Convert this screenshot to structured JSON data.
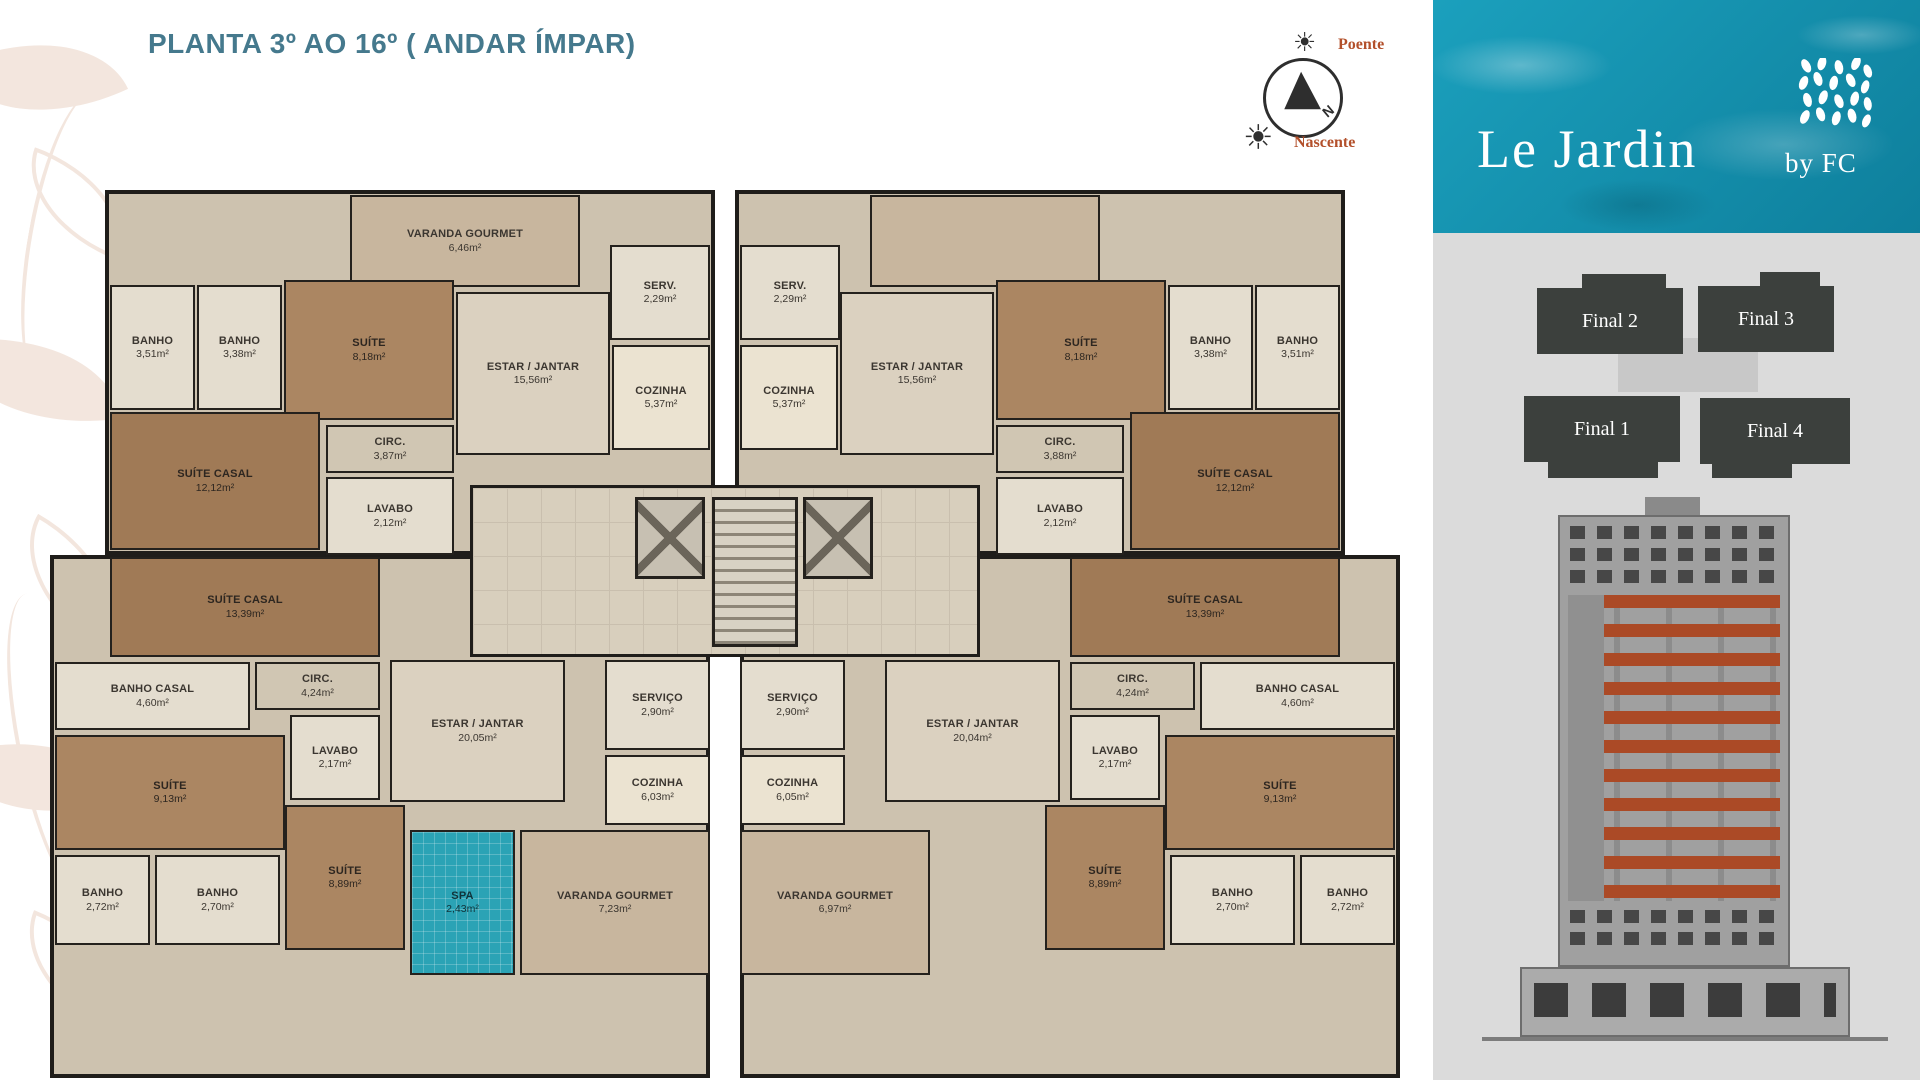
{
  "title": "PLANTA 3º AO 16º ( ANDAR ÍMPAR)",
  "compass": {
    "north": "N",
    "poente": "Poente",
    "nascente": "Nascente"
  },
  "brand": {
    "name": "Le Jardin",
    "by": "by FC"
  },
  "key_plan": {
    "final1": "Final 1",
    "final2": "Final 2",
    "final3": "Final 3",
    "final4": "Final 4"
  },
  "colors": {
    "title_teal": "#45798d",
    "accent_rust": "#b3502b",
    "sidebar_water": "#148ca8",
    "sidebar_gray": "#dbdbdb",
    "keyplan_block": "#3c403d",
    "elevation_highlight": "#ab4a26",
    "wall": "#1f1d1a"
  },
  "plan": {
    "top_left": {
      "varanda": {
        "label": "VARANDA GOURMET",
        "area": "6,46m²"
      },
      "serv": {
        "label": "SERV.",
        "area": "2,29m²"
      },
      "cozinha": {
        "label": "COZINHA",
        "area": "5,37m²"
      },
      "estar": {
        "label": "ESTAR / JANTAR",
        "area": "15,56m²"
      },
      "circ": {
        "label": "CIRC.",
        "area": "3,87m²"
      },
      "suite": {
        "label": "SUÍTE",
        "area": "8,18m²"
      },
      "banho_a": {
        "label": "BANHO",
        "area": "3,38m²"
      },
      "banho_b": {
        "label": "BANHO",
        "area": "3,51m²"
      },
      "suite_casal": {
        "label": "SUÍTE CASAL",
        "area": "12,12m²"
      },
      "lavabo": {
        "label": "LAVABO",
        "area": "2,12m²"
      }
    },
    "top_right": {
      "serv": {
        "label": "SERV.",
        "area": "2,29m²"
      },
      "cozinha": {
        "label": "COZINHA",
        "area": "5,37m²"
      },
      "estar": {
        "label": "ESTAR / JANTAR",
        "area": "15,56m²"
      },
      "circ": {
        "label": "CIRC.",
        "area": "3,88m²"
      },
      "suite": {
        "label": "SUÍTE",
        "area": "8,18m²"
      },
      "banho_a": {
        "label": "BANHO",
        "area": "3,38m²"
      },
      "banho_b": {
        "label": "BANHO",
        "area": "3,51m²"
      },
      "suite_casal": {
        "label": "SUÍTE CASAL",
        "area": "12,12m²"
      },
      "lavabo": {
        "label": "LAVABO",
        "area": "2,12m²"
      }
    },
    "bottom_left": {
      "suite_casal": {
        "label": "SUÍTE CASAL",
        "area": "13,39m²"
      },
      "banho_casal": {
        "label": "BANHO CASAL",
        "area": "4,60m²"
      },
      "circ": {
        "label": "CIRC.",
        "area": "4,24m²"
      },
      "lavabo": {
        "label": "LAVABO",
        "area": "2,17m²"
      },
      "suite_a": {
        "label": "SUÍTE",
        "area": "9,13m²"
      },
      "banho_a": {
        "label": "BANHO",
        "area": "2,72m²"
      },
      "banho_b": {
        "label": "BANHO",
        "area": "2,70m²"
      },
      "suite_b": {
        "label": "SUÍTE",
        "area": "8,89m²"
      },
      "spa": {
        "label": "SPA",
        "area": "2,43m²"
      },
      "estar": {
        "label": "ESTAR / JANTAR",
        "area": "20,05m²"
      },
      "servico": {
        "label": "SERVIÇO",
        "area": "2,90m²"
      },
      "cozinha": {
        "label": "COZINHA",
        "area": "6,03m²"
      },
      "varanda": {
        "label": "VARANDA GOURMET",
        "area": "7,23m²"
      }
    },
    "bottom_right": {
      "suite_casal": {
        "label": "SUÍTE CASAL",
        "area": "13,39m²"
      },
      "banho_casal": {
        "label": "BANHO CASAL",
        "area": "4,60m²"
      },
      "circ": {
        "label": "CIRC.",
        "area": "4,24m²"
      },
      "lavabo": {
        "label": "LAVABO",
        "area": "2,17m²"
      },
      "suite_a": {
        "label": "SUÍTE",
        "area": "9,13m²"
      },
      "banho_a": {
        "label": "BANHO",
        "area": "2,72m²"
      },
      "banho_b": {
        "label": "BANHO",
        "area": "2,70m²"
      },
      "suite_b": {
        "label": "SUÍTE",
        "area": "8,89m²"
      },
      "estar": {
        "label": "ESTAR / JANTAR",
        "area": "20,04m²"
      },
      "servico": {
        "label": "SERVIÇO",
        "area": "2,90m²"
      },
      "cozinha": {
        "label": "COZINHA",
        "area": "6,05m²"
      },
      "varanda": {
        "label": "VARANDA GOURMET",
        "area": "6,97m²"
      }
    }
  }
}
